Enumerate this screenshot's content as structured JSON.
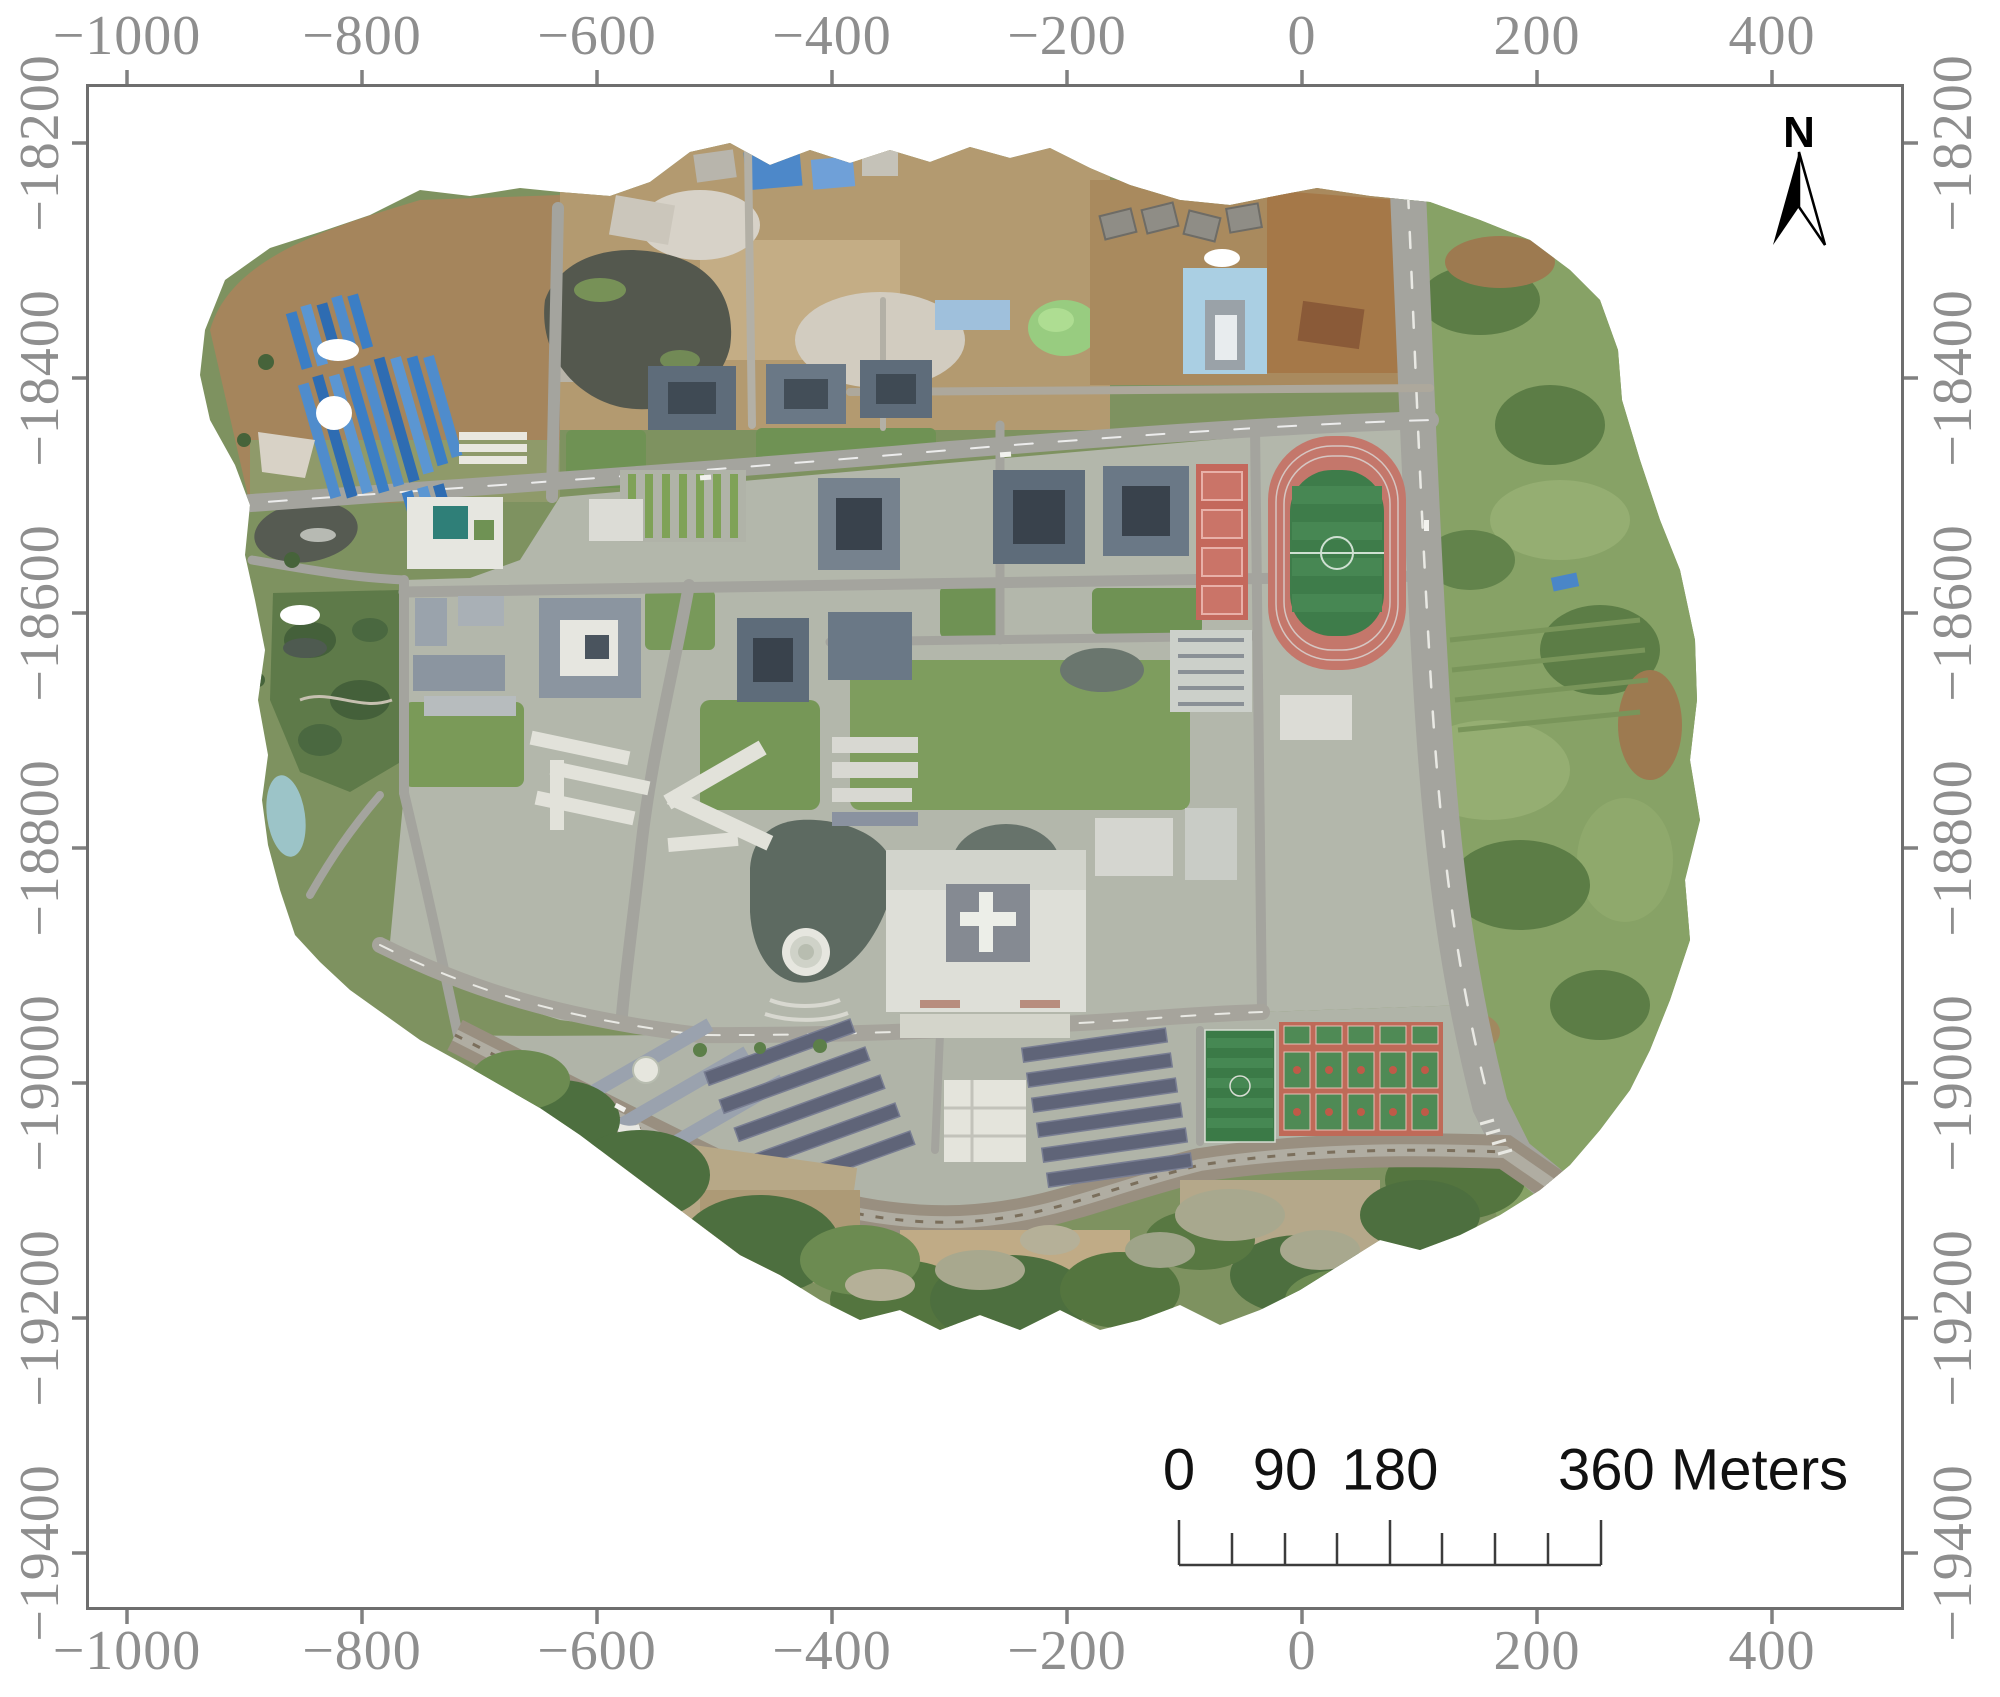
{
  "figure": {
    "background": "#ffffff",
    "description": "UAV orthomosaic map of a university campus with projected coordinate axes, north arrow and scale bar"
  },
  "axes": {
    "top": [
      "−1000",
      "−800",
      "−600",
      "−400",
      "−200",
      "0",
      "200",
      "400"
    ],
    "bottom": [
      "−1000",
      "−800",
      "−600",
      "−400",
      "−200",
      "0",
      "200",
      "400"
    ],
    "left": [
      "−18200",
      "−18400",
      "−18600",
      "−18800",
      "−19000",
      "−19200",
      "−19400"
    ],
    "right": [
      "−18200",
      "−18400",
      "−18600",
      "−18800",
      "−19000",
      "−19200",
      "−19400"
    ],
    "label_color": "#8e8e8e",
    "tick_color": "#808080",
    "frame_color": "#6e6e6e"
  },
  "north_arrow": {
    "label": "N",
    "fill": "#000000"
  },
  "scale_bar": {
    "labels": [
      "0",
      "90",
      "180"
    ],
    "end_label": "360 Meters",
    "unit": "Meters",
    "text_color": "#111111",
    "line_color": "#3c3c3c"
  },
  "map": {
    "palette": {
      "vegetation": "#7e9260",
      "hills": "#87a266",
      "forest": "#4d6f3f",
      "dirt": "#a5855c",
      "campus_ground": "#b3b7ab",
      "road": "#a4a49e",
      "water_lake": "#5d6a61",
      "water_muddy": "#a8a88e",
      "blue_sheds": "#3b7ec5",
      "track_red": "#c4776b",
      "track_infield": "#3e7c4a",
      "courts_red": "#bf6a58",
      "courts_green": "#4f8a55",
      "building_slate": "#5e6c7a",
      "building_white": "#e6e6e0",
      "dorm_roof": "#5f6478"
    },
    "landmarks": [
      "blue-roofed-sheds",
      "construction-site",
      "dark-pond",
      "running-track",
      "tennis-courts",
      "teaching-buildings",
      "admin-building",
      "hotel-pool",
      "parking-lot",
      "central-lake",
      "fountain",
      "library-complex",
      "dormitory-rows",
      "canteen",
      "soccer-fields",
      "basketball-courts",
      "campus-boulevard",
      "railway-corridor",
      "ring-avenue",
      "hillside-vegetation",
      "muddy-ponds",
      "garden"
    ]
  }
}
